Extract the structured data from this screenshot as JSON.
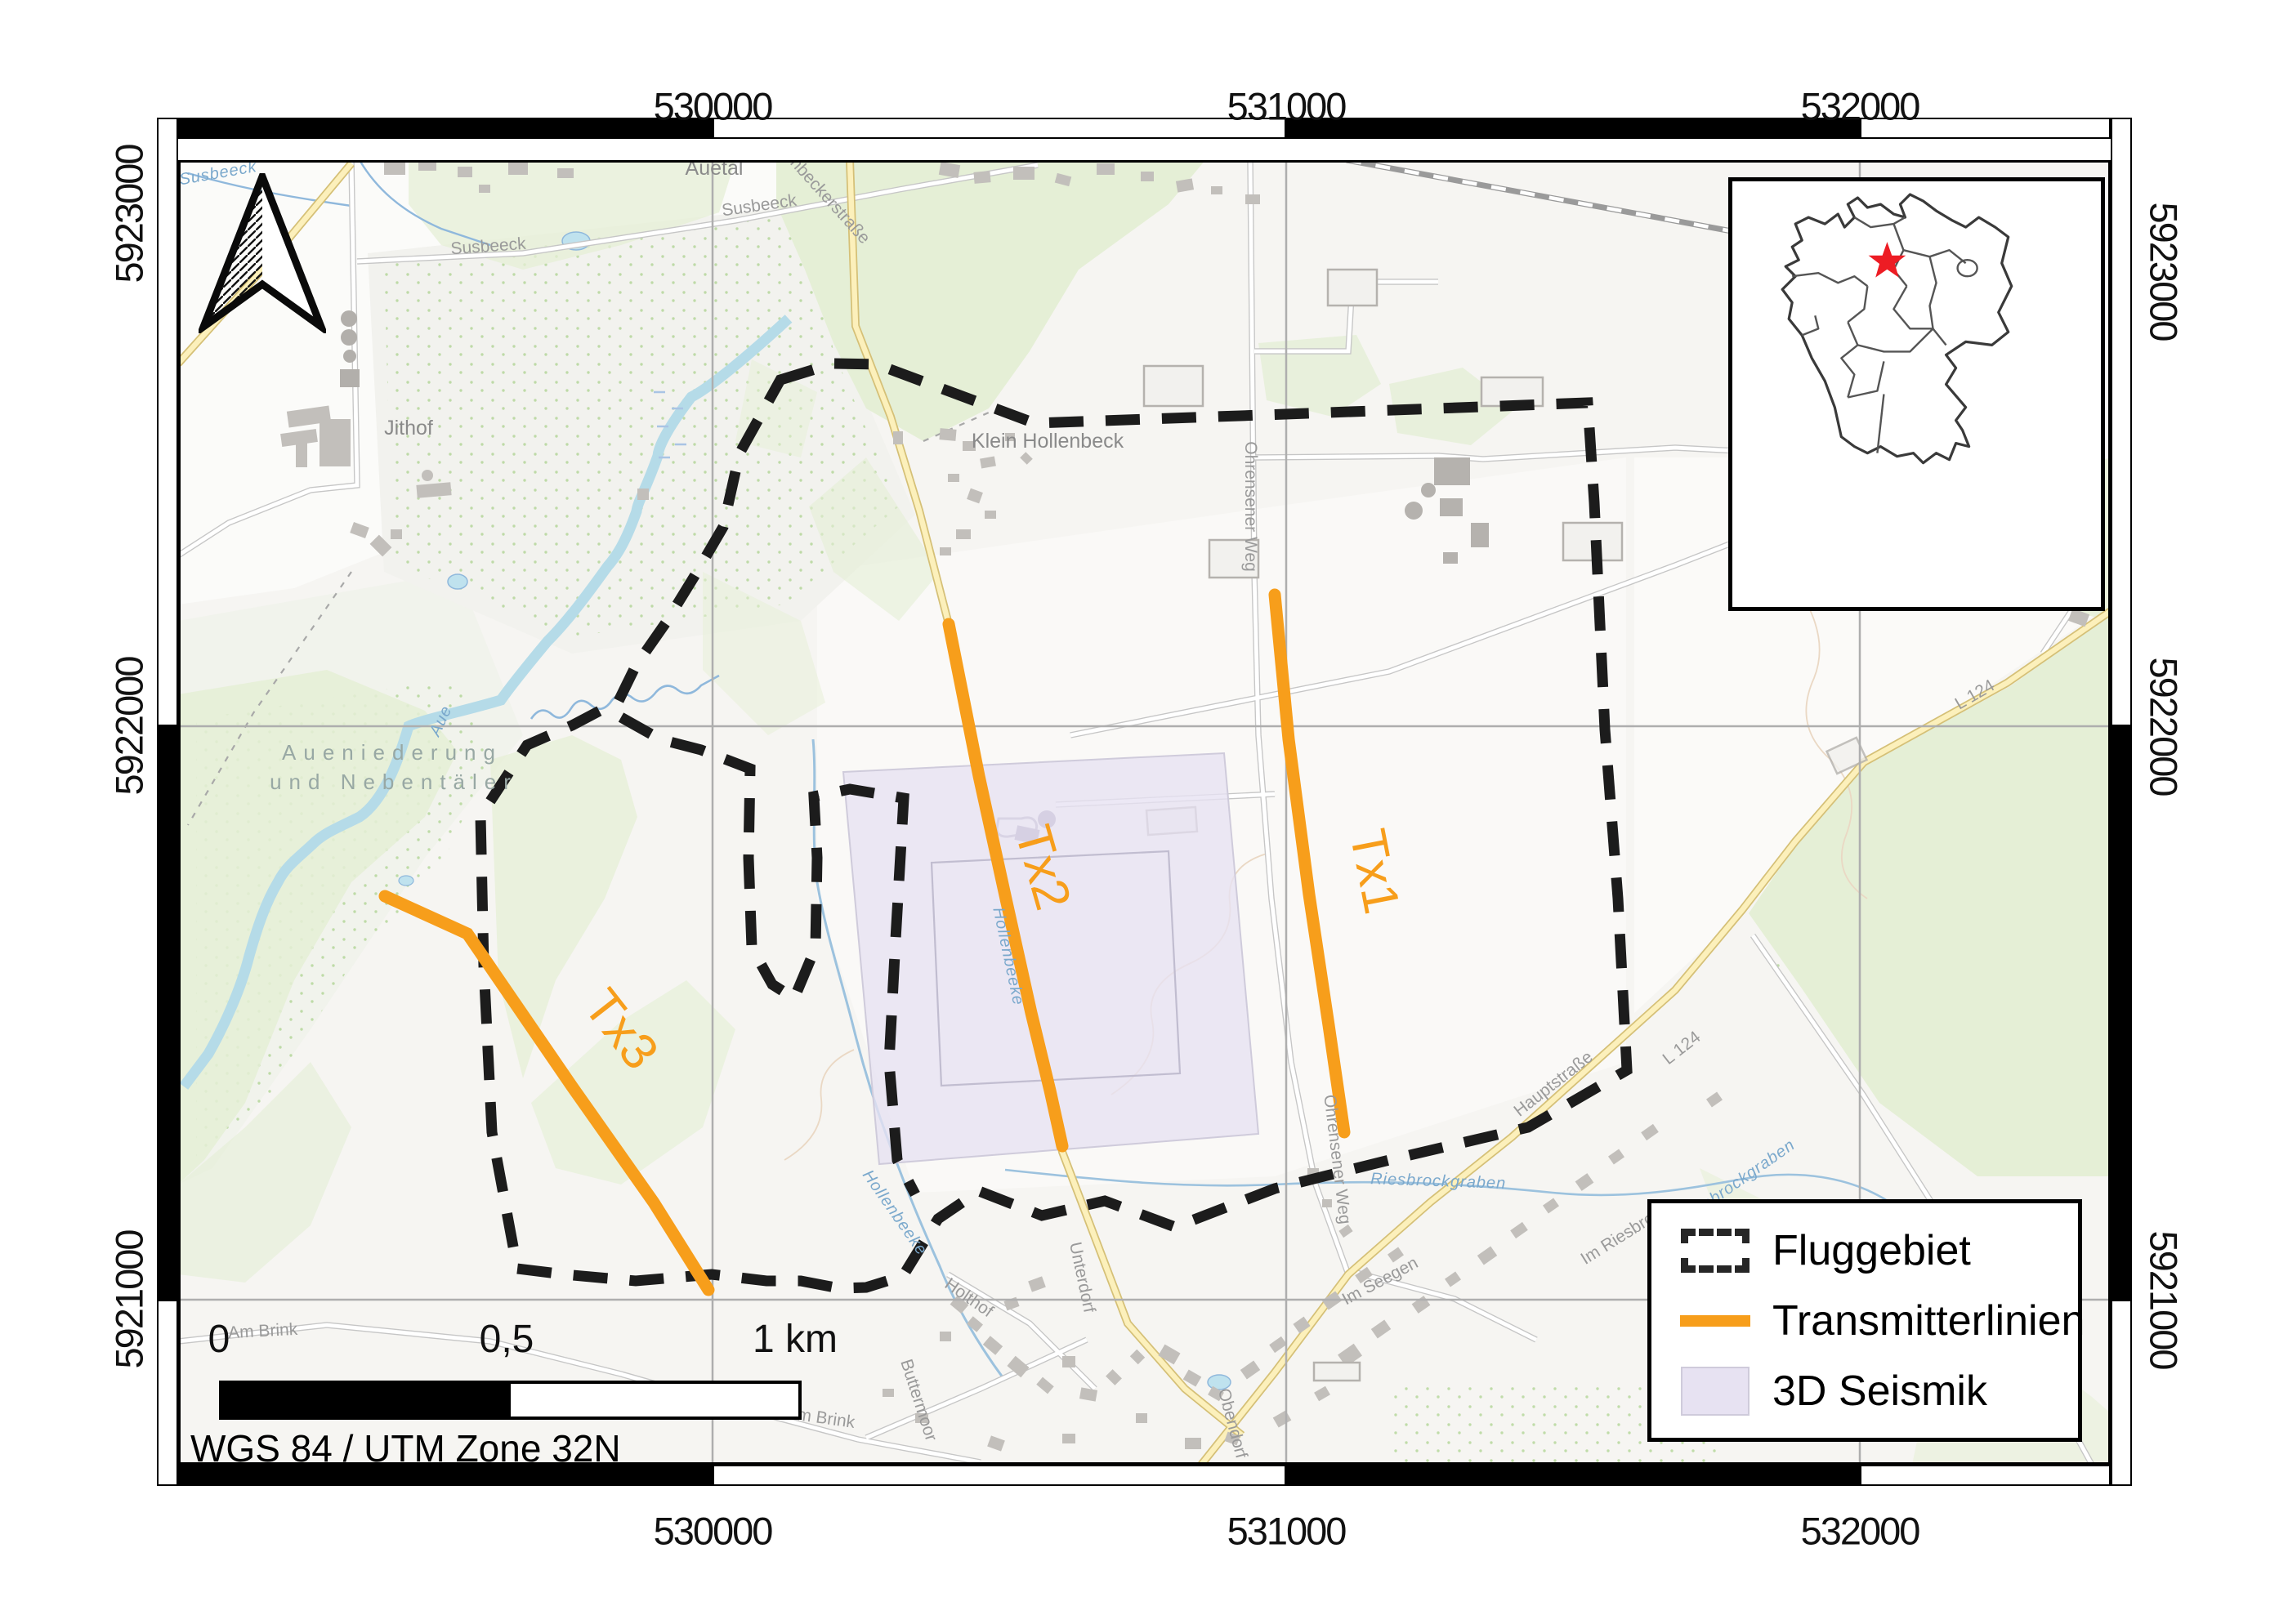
{
  "crs_label": "WGS 84 / UTM Zone 32N",
  "axes": {
    "x_ticks": [
      {
        "label": "530000",
        "px": 872
      },
      {
        "label": "531000",
        "px": 1574
      },
      {
        "label": "532000",
        "px": 2276
      }
    ],
    "y_ticks": [
      {
        "label": "5923000",
        "py_left": 262,
        "py_right": 332
      },
      {
        "label": "5922000",
        "py_left": 889,
        "py_right": 889
      },
      {
        "label": "5921000",
        "py_left": 1591,
        "py_right": 1591
      }
    ],
    "top_label_y": 130,
    "bottom_label_y": 1874,
    "left_label_x": 158,
    "right_label_x": 2648
  },
  "frame": {
    "zebra_x": [
      218,
      872,
      1574,
      2276,
      2583
    ],
    "zebra_y": [
      170,
      889,
      1591,
      1819
    ],
    "inner": [
      218,
      196,
      2583,
      1793
    ]
  },
  "grid": {
    "x": [
      872,
      1574,
      2276
    ],
    "y": [
      889,
      1591
    ],
    "color": "#aeaeae"
  },
  "scalebar": {
    "labels": [
      {
        "text": "0",
        "x": 0
      },
      {
        "text": "0,5",
        "x": 352
      },
      {
        "text": "1 km",
        "x": 705
      }
    ]
  },
  "legend": {
    "items": [
      {
        "symbol": "dashed-rect",
        "label": "Fluggebiet"
      },
      {
        "symbol": "orange-line",
        "label": "Transmitterlinien"
      },
      {
        "symbol": "purple-rect",
        "label": "3D Seismik"
      }
    ]
  },
  "inset": {
    "icon": "germany-states-map",
    "star_icon": "red-star",
    "star_vb": [
      82,
      49
    ]
  },
  "north_arrow_icon": "north-arrow",
  "transmitter_lines": [
    {
      "name": "Tx1",
      "points": [
        [
          1560,
          728
        ],
        [
          1577,
          905
        ],
        [
          1602,
          1095
        ],
        [
          1626,
          1255
        ],
        [
          1645,
          1386
        ]
      ],
      "label": "Tx1",
      "label_x": 1652,
      "label_y": 1020,
      "label_rot": 79
    },
    {
      "name": "Tx2",
      "points": [
        [
          1161,
          764
        ],
        [
          1198,
          950
        ],
        [
          1232,
          1105
        ],
        [
          1262,
          1240
        ],
        [
          1285,
          1335
        ],
        [
          1300,
          1403
        ]
      ],
      "label": "Tx2",
      "label_x": 1242,
      "label_y": 1018,
      "label_rot": 74
    },
    {
      "name": "Tx3",
      "points": [
        [
          471,
          1097
        ],
        [
          572,
          1143
        ],
        [
          700,
          1330
        ],
        [
          800,
          1472
        ],
        [
          867,
          1579
        ]
      ],
      "label": "Tx3",
      "label_x": 712,
      "label_y": 1232,
      "label_rot": 52
    }
  ],
  "fluggebiet": {
    "outline": [
      [
        955,
        465
      ],
      [
        1020,
        445
      ],
      [
        1073,
        446
      ],
      [
        1266,
        518
      ],
      [
        1600,
        506
      ],
      [
        1943,
        493
      ],
      [
        1951,
        615
      ],
      [
        1964,
        893
      ],
      [
        1980,
        1100
      ],
      [
        1991,
        1310
      ],
      [
        1870,
        1380
      ],
      [
        1700,
        1420
      ],
      [
        1560,
        1455
      ],
      [
        1438,
        1502
      ],
      [
        1352,
        1470
      ],
      [
        1275,
        1488
      ],
      [
        1198,
        1458
      ],
      [
        1148,
        1492
      ],
      [
        1105,
        1562
      ],
      [
        1060,
        1576
      ],
      [
        1027,
        1577
      ],
      [
        980,
        1568
      ],
      [
        938,
        1568
      ],
      [
        871,
        1560
      ],
      [
        778,
        1568
      ],
      [
        690,
        1560
      ],
      [
        633,
        1553
      ],
      [
        602,
        1386
      ],
      [
        592,
        1182
      ],
      [
        588,
        999
      ],
      [
        645,
        912
      ],
      [
        700,
        888
      ],
      [
        757,
        858
      ],
      [
        778,
        815
      ],
      [
        815,
        762
      ],
      [
        850,
        705
      ],
      [
        885,
        645
      ],
      [
        905,
        555
      ]
    ],
    "creek_notch": [
      [
        760,
        878
      ],
      [
        808,
        905
      ],
      [
        858,
        918
      ],
      [
        918,
        941
      ],
      [
        916,
        1050
      ],
      [
        920,
        1160
      ],
      [
        945,
        1205
      ],
      [
        972,
        1222
      ],
      [
        998,
        1160
      ],
      [
        1000,
        1050
      ],
      [
        996,
        975
      ],
      [
        1040,
        966
      ],
      [
        1106,
        977
      ],
      [
        1096,
        1150
      ],
      [
        1088,
        1300
      ],
      [
        1098,
        1420
      ],
      [
        1120,
        1462
      ]
    ]
  },
  "seismik": {
    "outer": [
      [
        1032,
        945
      ],
      [
        1498,
        922
      ],
      [
        1540,
        1388
      ],
      [
        1076,
        1425
      ]
    ],
    "inner": [
      [
        1140,
        1056
      ],
      [
        1430,
        1042
      ],
      [
        1444,
        1314
      ],
      [
        1152,
        1329
      ]
    ]
  },
  "map_labels": [
    {
      "text": "Jithof",
      "x": 500,
      "y": 532,
      "rot": 0,
      "cls": "place"
    },
    {
      "text": "Klein Hollenbeck",
      "x": 1282,
      "y": 548,
      "rot": 0,
      "cls": "place"
    },
    {
      "text": "Auetal",
      "x": 874,
      "y": 214,
      "rot": 0,
      "cls": "place"
    },
    {
      "text": "Susbeeck",
      "x": 598,
      "y": 308,
      "rot": -4,
      "cls": "road"
    },
    {
      "text": "Susbeeck",
      "x": 930,
      "y": 258,
      "rot": -8,
      "cls": "road"
    },
    {
      "text": "Hollenbeckerstraße",
      "x": 995,
      "y": 232,
      "rot": 48,
      "cls": "road"
    },
    {
      "text": "Aueniederung",
      "x": 480,
      "y": 930,
      "rot": 0,
      "cls": "area"
    },
    {
      "text": "und Nebentäler",
      "x": 482,
      "y": 966,
      "rot": 0,
      "cls": "area"
    },
    {
      "text": "Ohrensener Weg",
      "x": 1524,
      "y": 620,
      "rot": 90,
      "cls": "road"
    },
    {
      "text": "Ohrensener Weg",
      "x": 1630,
      "y": 1420,
      "rot": 83,
      "cls": "road"
    },
    {
      "text": "Hauptstraße",
      "x": 1905,
      "y": 1332,
      "rot": -38,
      "cls": "road"
    },
    {
      "text": "L 124",
      "x": 2420,
      "y": 856,
      "rot": -30,
      "cls": "road"
    },
    {
      "text": "L 124",
      "x": 2062,
      "y": 1288,
      "rot": -38,
      "cls": "road"
    },
    {
      "text": "Unterdorf",
      "x": 1318,
      "y": 1565,
      "rot": 78,
      "cls": "road"
    },
    {
      "text": "Holthof",
      "x": 1182,
      "y": 1594,
      "rot": 35,
      "cls": "road"
    },
    {
      "text": "Am Brink",
      "x": 322,
      "y": 1636,
      "rot": -3,
      "cls": "road"
    },
    {
      "text": "Am Brink",
      "x": 1003,
      "y": 1742,
      "rot": 8,
      "cls": "road"
    },
    {
      "text": "Buttermoor",
      "x": 1118,
      "y": 1716,
      "rot": 72,
      "cls": "road"
    },
    {
      "text": "Im Seegen",
      "x": 1692,
      "y": 1574,
      "rot": -28,
      "cls": "road"
    },
    {
      "text": "Obendorf",
      "x": 1502,
      "y": 1744,
      "rot": 75,
      "cls": "road"
    },
    {
      "text": "Im Riesbrock",
      "x": 1992,
      "y": 1516,
      "rot": -32,
      "cls": "road"
    },
    {
      "text": "Hollenbeeke",
      "x": 1228,
      "y": 1172,
      "rot": 78,
      "cls": "water"
    },
    {
      "text": "Hollenbeeke",
      "x": 1090,
      "y": 1488,
      "rot": 55,
      "cls": "water"
    },
    {
      "text": "Riesbrockgraben",
      "x": 1760,
      "y": 1452,
      "rot": 2,
      "cls": "water"
    },
    {
      "text": "Riesbrockgraben",
      "x": 2130,
      "y": 1452,
      "rot": -35,
      "cls": "water"
    },
    {
      "text": "Aue",
      "x": 545,
      "y": 885,
      "rot": -65,
      "cls": "water"
    },
    {
      "text": "Susbeeck",
      "x": 268,
      "y": 218,
      "rot": -10,
      "cls": "water"
    }
  ],
  "colors": {
    "transmitter_orange": "#F79E1B",
    "boundary_black": "#1c1c1c",
    "seismik_fill": "#E7E2F2",
    "star_red": "#ED1C24",
    "grid_gray": "#aeaeae",
    "forest_green": "#e5efd6",
    "water_blue": "#b5dbe8"
  }
}
